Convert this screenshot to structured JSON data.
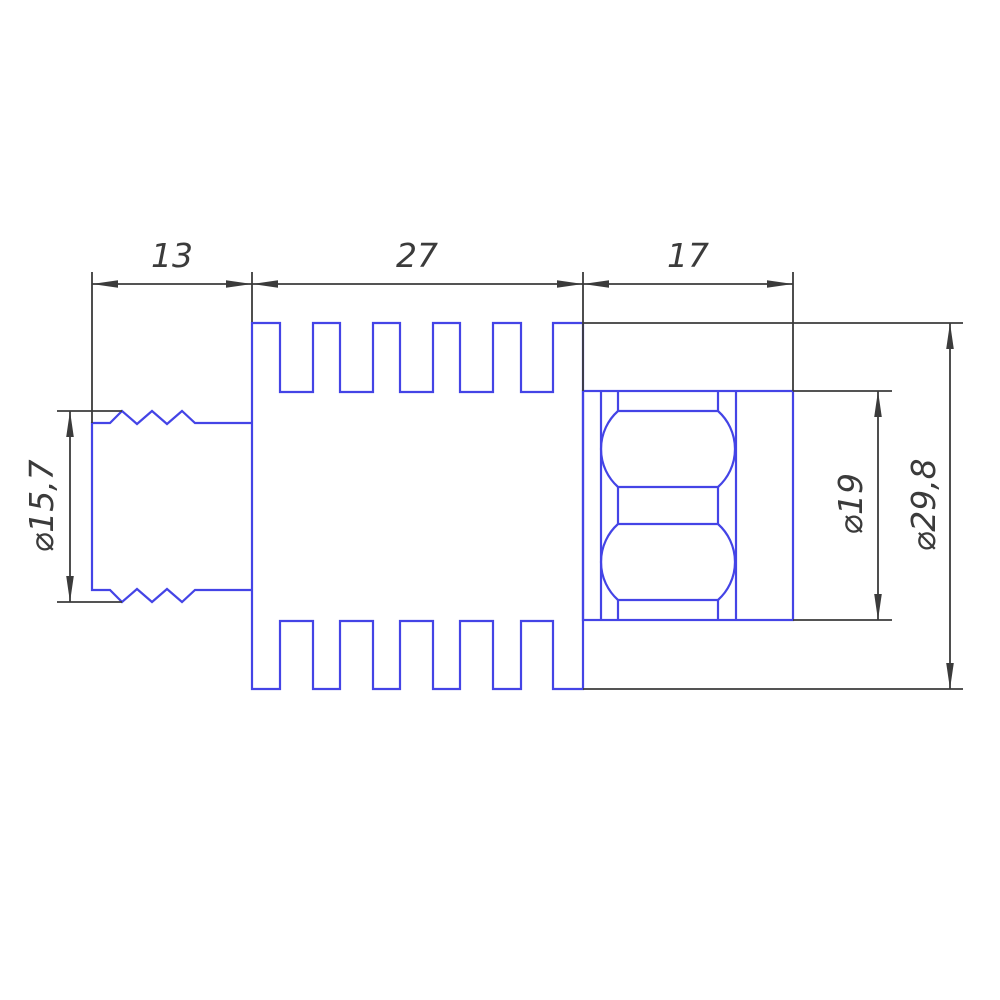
{
  "drawing": {
    "type": "engineering-section-view",
    "units": "mm",
    "colors": {
      "part": "#4444e6",
      "dimension": "#3b3b3b",
      "background": "#ffffff"
    },
    "length_dimensions": [
      {
        "id": "threaded-stub-length",
        "label": "13",
        "value": 13
      },
      {
        "id": "finned-body-length",
        "label": "27",
        "value": 27
      },
      {
        "id": "bearing-section-length",
        "label": "17",
        "value": 17
      }
    ],
    "diameter_dimensions": [
      {
        "id": "thread-diameter",
        "label": "⌀15,7",
        "value": 15.7
      },
      {
        "id": "bearing-outer-diameter",
        "label": "⌀19",
        "value": 19
      },
      {
        "id": "fin-outer-diameter",
        "label": "⌀29,8",
        "value": 29.8
      }
    ]
  }
}
